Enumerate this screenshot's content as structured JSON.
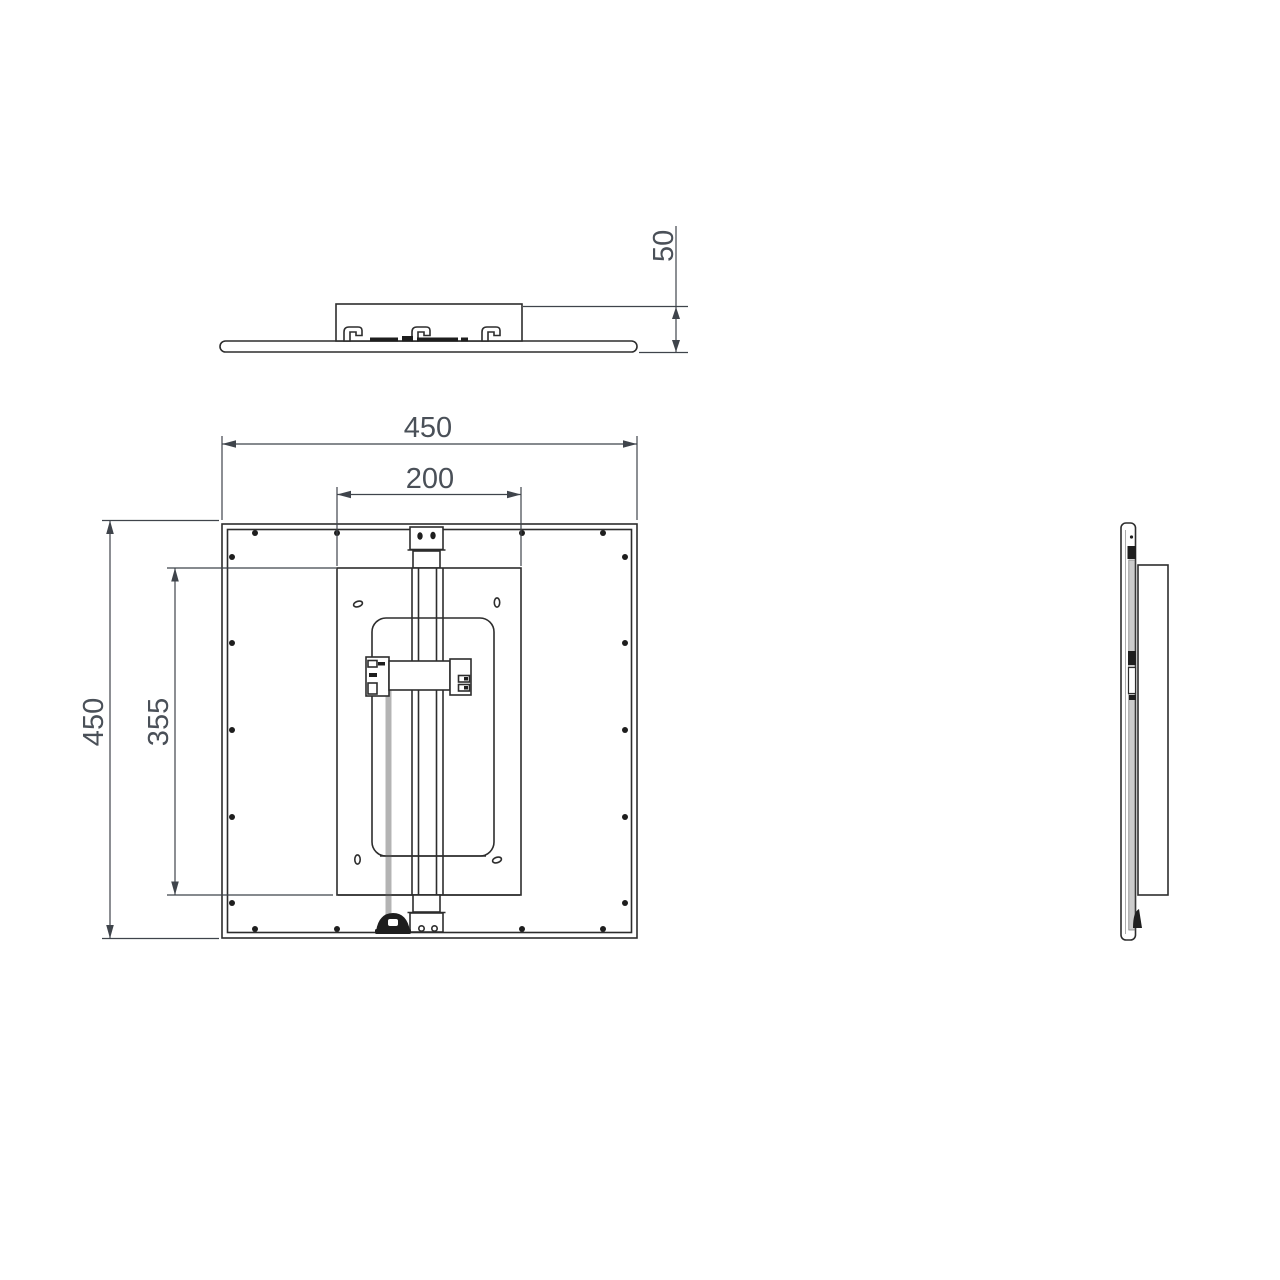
{
  "drawing": {
    "colors": {
      "line": "#2d2d2d",
      "dimension_text": "#4a5058",
      "cable_gray": "#b4b4b4",
      "side_strip_gray": "#cccccc",
      "background": "#ffffff"
    },
    "dimensions": {
      "profile_height": "50",
      "plan_width": "450",
      "plan_height": "450",
      "mount_bracket_span": "200",
      "mount_plate_span": "355"
    }
  }
}
